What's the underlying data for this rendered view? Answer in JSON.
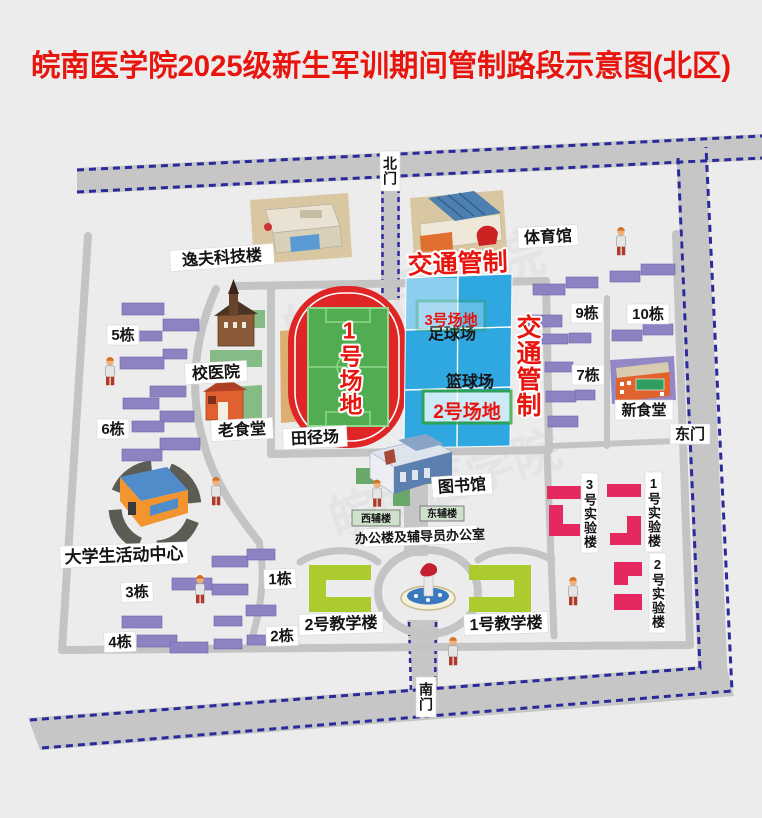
{
  "title": "皖南医学院2025级新生军训期间管制路段示意图(北区)",
  "watermark": "皖南医学院",
  "traffic_control": "交通管制",
  "gates": {
    "north": "北门",
    "east": "东门",
    "south": "南门"
  },
  "grounds": {
    "g1": "1号场地",
    "g2": "2号场地",
    "g3": "3号场地"
  },
  "sports": {
    "track_field": "田径场",
    "football": "足球场",
    "basketball": "篮球场"
  },
  "buildings": {
    "yifu": "逸夫科技楼",
    "gym": "体育馆",
    "hospital": "校医院",
    "old_canteen": "老食堂",
    "new_canteen": "新食堂",
    "library": "图书馆",
    "west_annex": "西辅楼",
    "east_annex": "东辅楼",
    "office": "办公楼及辅导员办公室",
    "activity_center": "大学生活动中心",
    "teach1": "1号教学楼",
    "teach2": "2号教学楼",
    "lab1": "1号实验楼",
    "lab2": "2号实验楼",
    "lab3": "3号实验楼"
  },
  "dorms": {
    "d1": "1栋",
    "d2": "2栋",
    "d3": "3栋",
    "d4": "4栋",
    "d5": "5栋",
    "d6": "6栋",
    "d7": "7栋",
    "d9": "9栋",
    "d10": "10栋"
  },
  "colors": {
    "title_red": "#e8140e",
    "control_red": "#e8140e",
    "dashed_blue": "#2a2a9b",
    "road_gray": "#c6c6c6",
    "court_blue": "#2fa7e0",
    "track_red": "#df2525",
    "field_green": "#52ad52",
    "dorm_purple": "#8d83c3",
    "teaching_green": "#abcb2e",
    "lab_pink": "#e5285f",
    "venue_box_green": "#2da02d"
  }
}
